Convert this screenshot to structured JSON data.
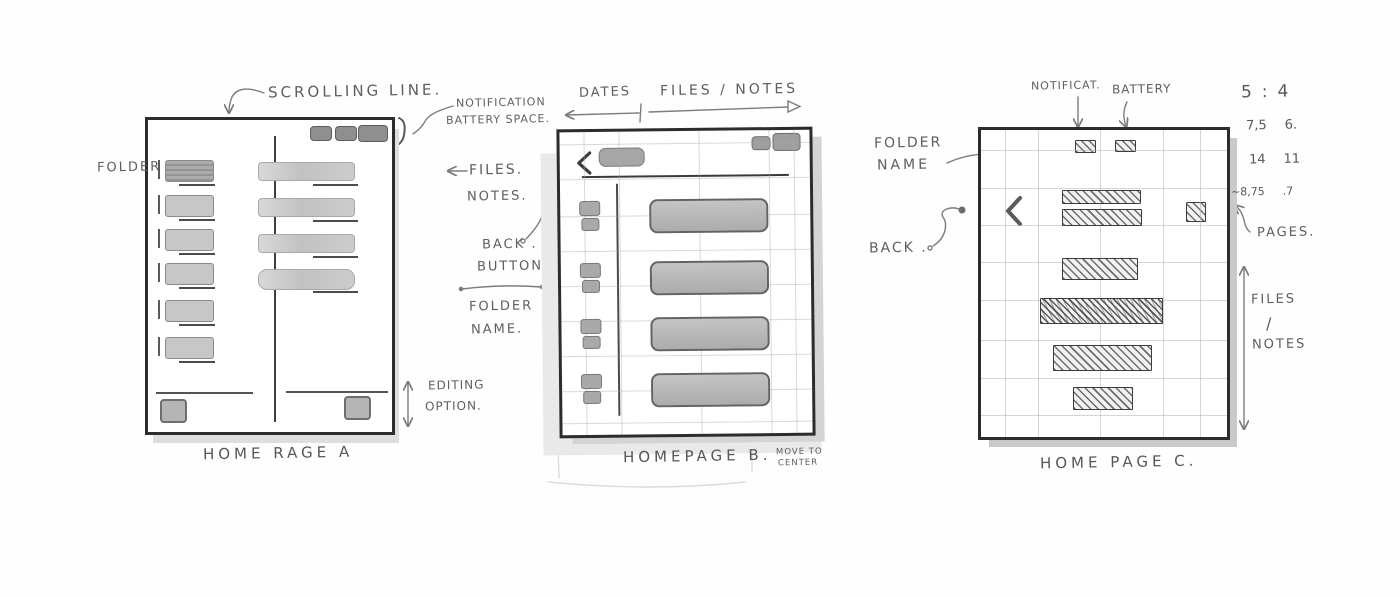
{
  "panels": {
    "a": {
      "caption": "HOME RAGE A",
      "scrolling_line_label": "SCROLLING LINE.",
      "notification_label": "NOTIFICATION",
      "battery_space_label": "BATTERY SPACE.",
      "folder_label": "FOLDER",
      "files_label": "FILES.",
      "notes_label": "NOTES.",
      "editing_label": "EDITING",
      "option_label": "OPTION.",
      "folder_count": 6,
      "file_count": 4,
      "status_pill_count": 3
    },
    "b": {
      "caption": "HOMEPAGE B.",
      "dates_label": "DATES",
      "files_notes_label": "FILES / NOTES",
      "back_label": "BACK .",
      "button_label": "BUTTON",
      "folder_label": "FOLDER",
      "name_label": "NAME.",
      "move_to_label": "MOVE TO",
      "center_label": "CENTER",
      "date_group_count": 4,
      "file_count": 4
    },
    "c": {
      "caption": "HOME PAGE C.",
      "notificat_label": "NOTIFICAT.",
      "battery_label": "BATTERY",
      "folder_label": "FOLDER",
      "name_label": "NAME",
      "back_label": "BACK .",
      "pages_label": "PAGES.",
      "files_label": "FILES",
      "slash_label": "/",
      "notes_label": "NOTES",
      "bar_count": 6,
      "measurements": [
        {
          "left": "5",
          "sep": ":",
          "right": "4"
        },
        {
          "left": "7,5",
          "right": "6."
        },
        {
          "left": "14",
          "right": "11"
        },
        {
          "left": "~8,75",
          "right": ".7"
        }
      ]
    }
  },
  "colors": {
    "paper": "#fefefe",
    "ink_frame": "#2c2c2c",
    "graphite_text": "#5e5e5e",
    "fill_light": "#c7c7c7",
    "fill_mid": "#a6a6a6",
    "fill_dark": "#8f8f8f",
    "grid_line": "#c9cfd2",
    "shadow": "#d4d4d4"
  }
}
